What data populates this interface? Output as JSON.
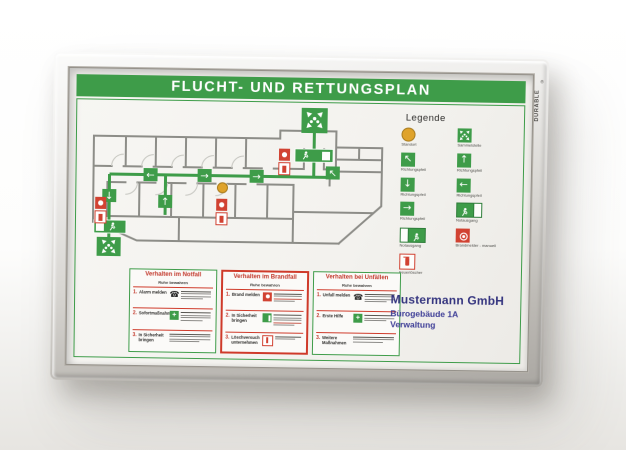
{
  "frame": {
    "brand": "DURABLE"
  },
  "poster": {
    "title": "FLUCHT- UND RETTUNGSPLAN",
    "legend": {
      "heading": "Legende",
      "items": [
        {
          "icon": "standort-icon",
          "label": "Standort"
        },
        {
          "icon": "sammelstelle-icon",
          "label": "Sammelstelle"
        },
        {
          "icon": "arrow-up-left-icon",
          "label": "Richtungspfeil",
          "glyph": "↖"
        },
        {
          "icon": "arrow-up-icon",
          "label": "Richtungspfeil",
          "glyph": "↑"
        },
        {
          "icon": "arrow-down-icon",
          "label": "Richtungspfeil",
          "glyph": "↓"
        },
        {
          "icon": "arrow-left-icon",
          "label": "Richtungspfeil",
          "glyph": "←"
        },
        {
          "icon": "arrow-right-icon",
          "label": "Richtungspfeil",
          "glyph": "→"
        },
        {
          "icon": "notausgang-right-icon",
          "label": "Notausgang"
        },
        {
          "icon": "notausgang-left-icon",
          "label": "Notausgang"
        },
        {
          "icon": "brandmelder-icon",
          "label": "Brandmelder - manuell"
        },
        {
          "icon": "feuerloescher-icon",
          "label": "Feuerlöscher"
        }
      ]
    },
    "plan": {
      "arrows": [
        {
          "dir": "left",
          "glyph": "←"
        },
        {
          "dir": "right",
          "glyph": "→"
        },
        {
          "dir": "right",
          "glyph": "→"
        },
        {
          "dir": "down",
          "glyph": "↓"
        },
        {
          "dir": "up",
          "glyph": "↑"
        },
        {
          "dir": "up-left",
          "glyph": "↖"
        }
      ]
    },
    "panels": [
      {
        "title": "Verhalten im Notfall",
        "subtitle": "Ruhe bewahren",
        "steps": [
          {
            "num": "1.",
            "label": "Alarm melden"
          },
          {
            "num": "2.",
            "label": "Sofortmaßnahmen"
          },
          {
            "num": "3.",
            "label": "In Sicherheit bringen"
          }
        ]
      },
      {
        "title": "Verhalten im Brandfall",
        "subtitle": "Ruhe bewahren",
        "steps": [
          {
            "num": "1.",
            "label": "Brand melden"
          },
          {
            "num": "2.",
            "label": "In Sicherheit bringen"
          },
          {
            "num": "3.",
            "label": "Löschversuch unternehmen"
          }
        ]
      },
      {
        "title": "Verhalten bei Unfällen",
        "subtitle": "Ruhe bewahren",
        "steps": [
          {
            "num": "1.",
            "label": "Unfall melden"
          },
          {
            "num": "2.",
            "label": "Erste Hilfe"
          },
          {
            "num": "3.",
            "label": "Weitere Maßnahmen"
          }
        ]
      }
    ],
    "company": {
      "name": "Mustermann GmbH",
      "building": "Bürogebäude 1A",
      "department": "Verwaltung"
    },
    "colors": {
      "green": "#3e9c49",
      "red": "#d14232",
      "yellow": "#dfa32b",
      "blue": "#35357f",
      "wall": "#8d8d88"
    }
  }
}
